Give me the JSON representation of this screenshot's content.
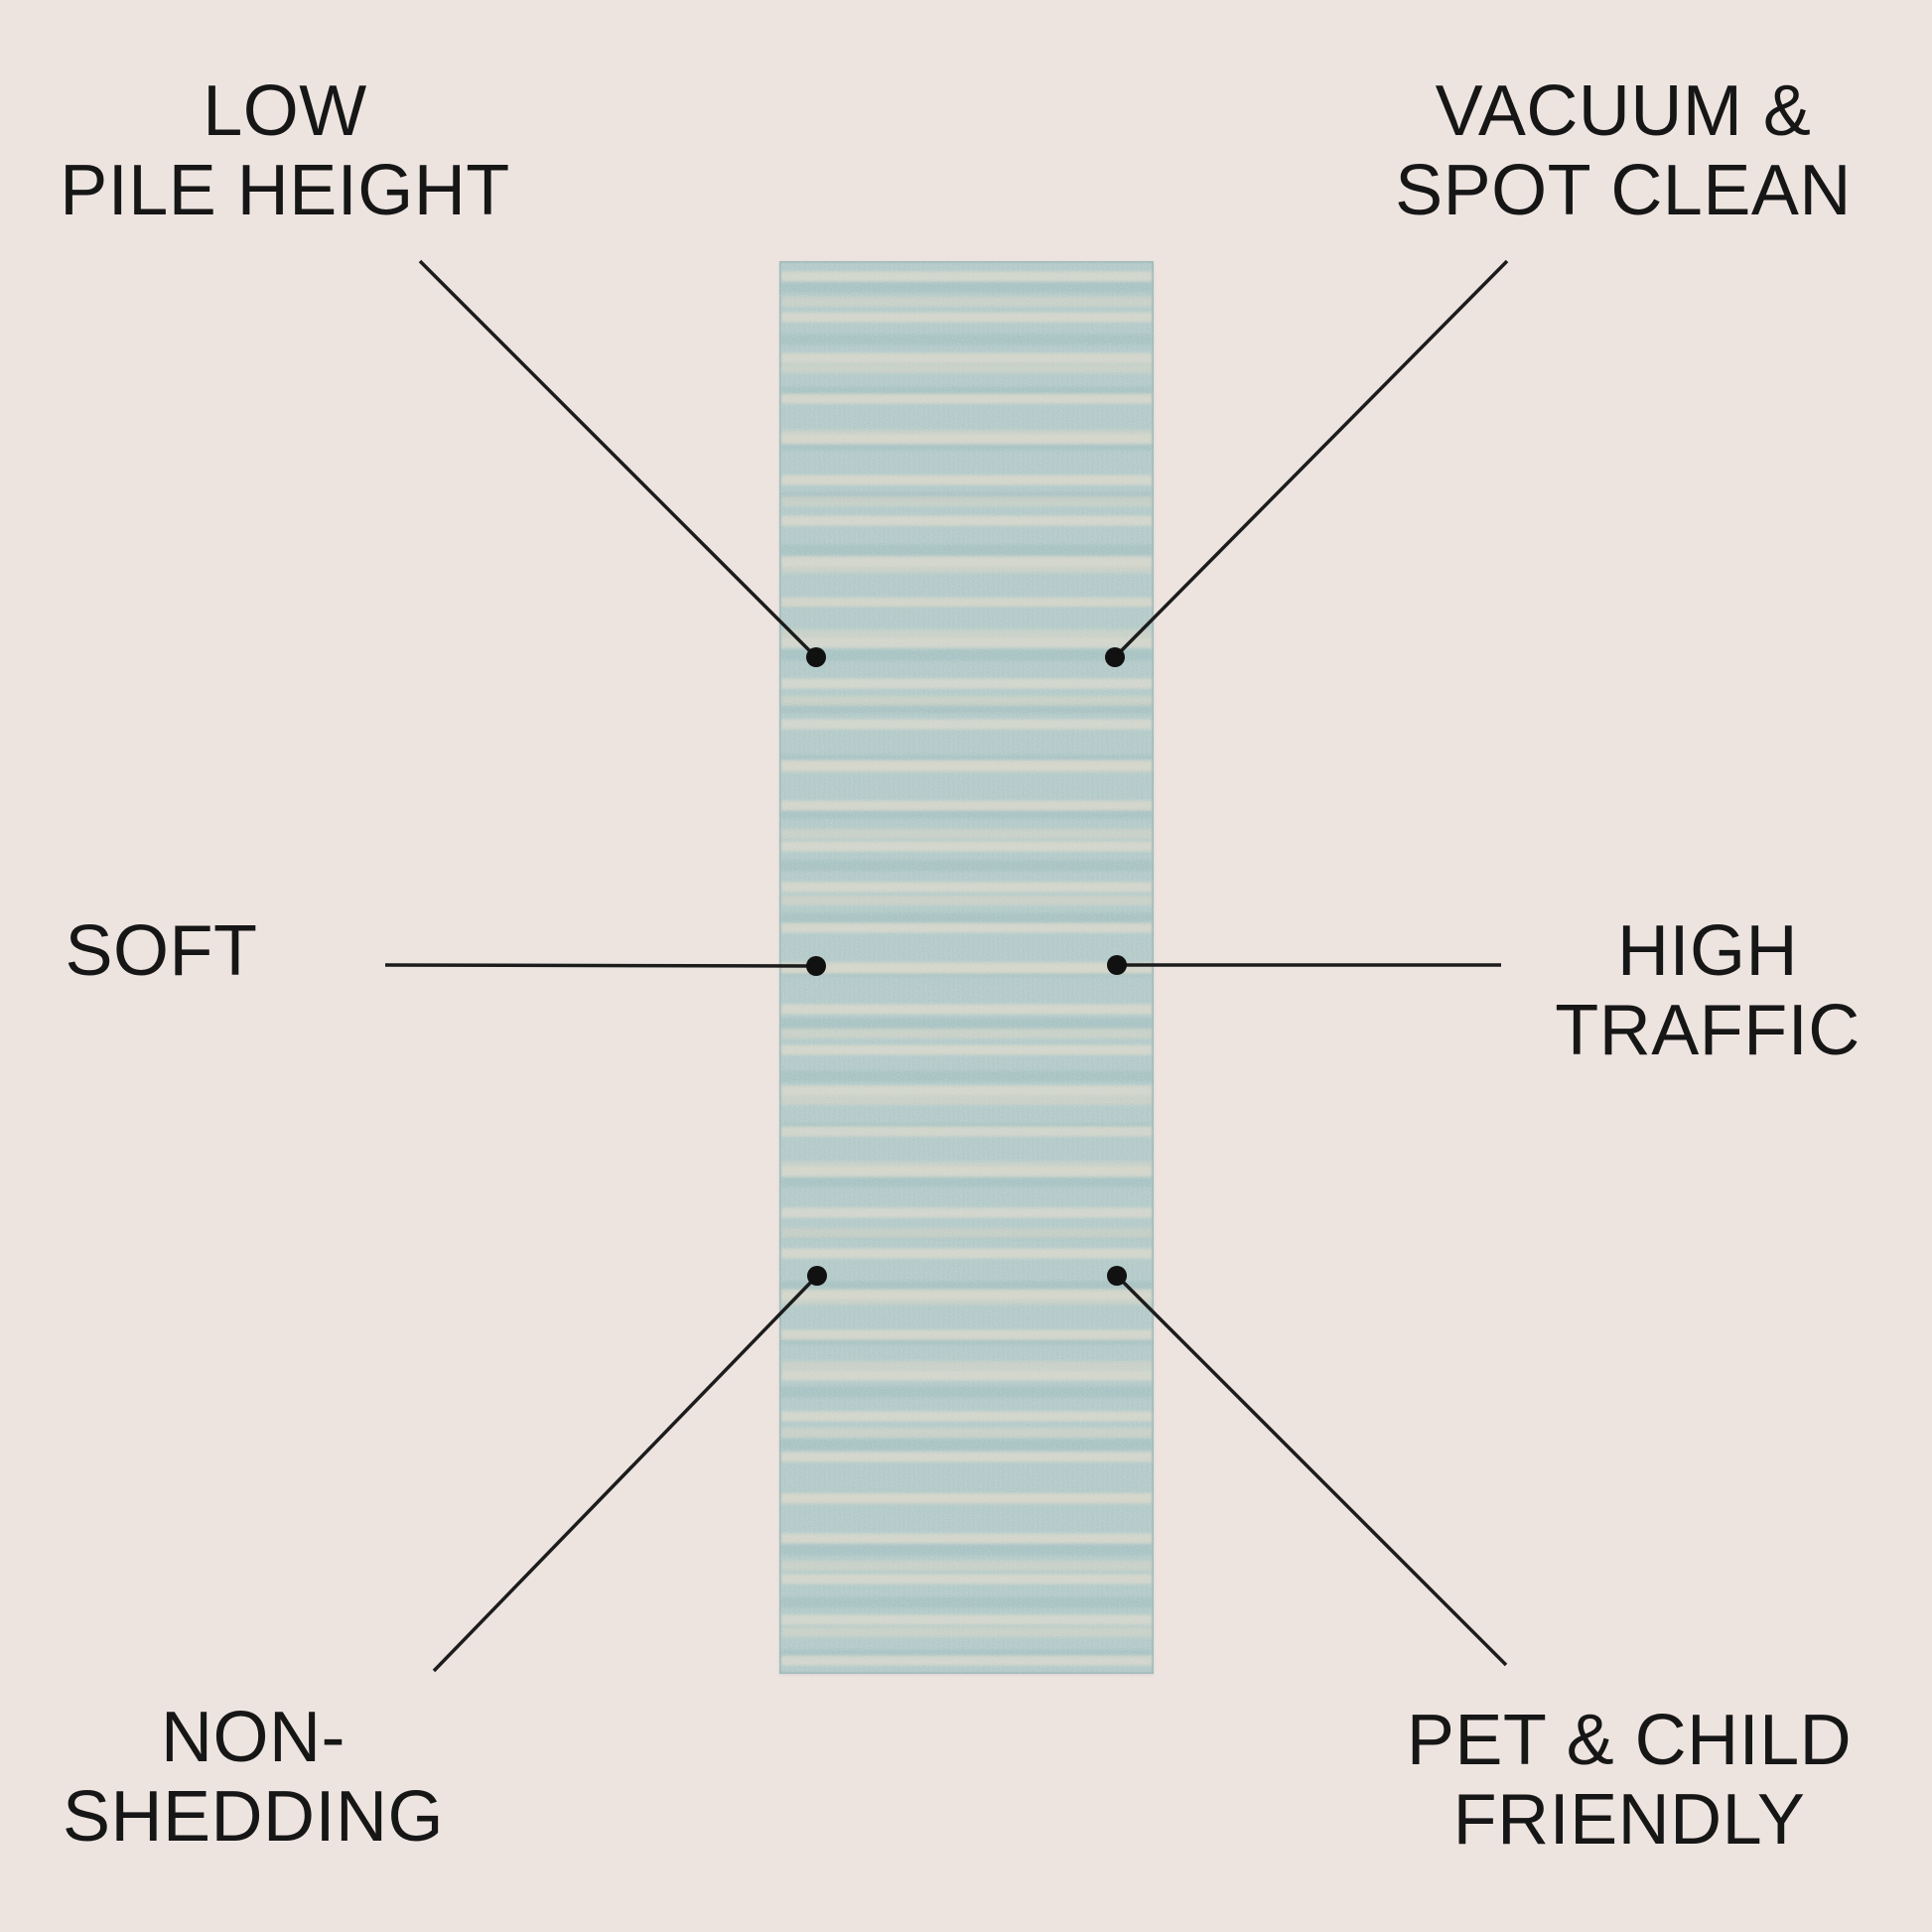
{
  "page": {
    "description": "Rug feature callout infographic",
    "background_color": "#ede4e0"
  },
  "colors": {
    "text": "#161616",
    "line": "#1c1c1c",
    "dot": "#111111",
    "rug_base": "#a6c3c4",
    "rug_stripe": "#d8d4c5",
    "rug_edge": "#769c9e"
  },
  "rug": {
    "type": "runner-rug",
    "pattern": "heathered horizontal broken stripes"
  },
  "features": [
    {
      "id": "low-pile-height",
      "position": "top-left",
      "label": "LOW\nPILE HEIGHT"
    },
    {
      "id": "vacuum-spot-clean",
      "position": "top-right",
      "label": "VACUUM &\nSPOT CLEAN"
    },
    {
      "id": "soft",
      "position": "middle-left",
      "label": "SOFT"
    },
    {
      "id": "high-traffic",
      "position": "middle-right",
      "label": "HIGH\nTRAFFIC"
    },
    {
      "id": "non-shedding",
      "position": "bottom-left",
      "label": "NON-\nSHEDDING"
    },
    {
      "id": "pet-child-friendly",
      "position": "bottom-right",
      "label": "PET & CHILD\nFRIENDLY"
    }
  ]
}
